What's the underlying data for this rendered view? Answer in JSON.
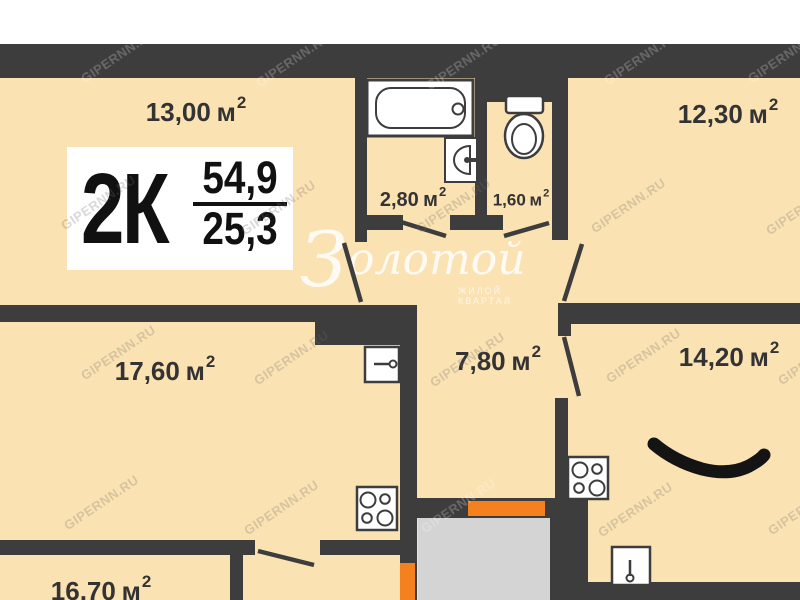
{
  "plan": {
    "badge": {
      "type": "2К",
      "total_area": "54,9",
      "living_area": "25,3"
    },
    "unit": "м",
    "unit_sup": "2",
    "rooms": [
      {
        "key": "room-13-00",
        "area": "13,00"
      },
      {
        "key": "room-12-30",
        "area": "12,30"
      },
      {
        "key": "bathroom",
        "area": "2,80"
      },
      {
        "key": "wc",
        "area": "1,60"
      },
      {
        "key": "room-17-60",
        "area": "17,60"
      },
      {
        "key": "hallway",
        "area": "7,80"
      },
      {
        "key": "room-14-20",
        "area": "14,20"
      },
      {
        "key": "room-16-70",
        "area": "16,70"
      }
    ],
    "watermark": {
      "text": "GIPERNN.RU"
    },
    "logo": {
      "initial": "З",
      "rest": "олотой",
      "subtitle": "ЖИЛОЙ КВАРТАЛ"
    },
    "colors": {
      "wall": "#3d3d3d",
      "floor": "#fbe2b2",
      "door_accent": "#f5811e",
      "stairwell": "#d4d4d4"
    }
  }
}
